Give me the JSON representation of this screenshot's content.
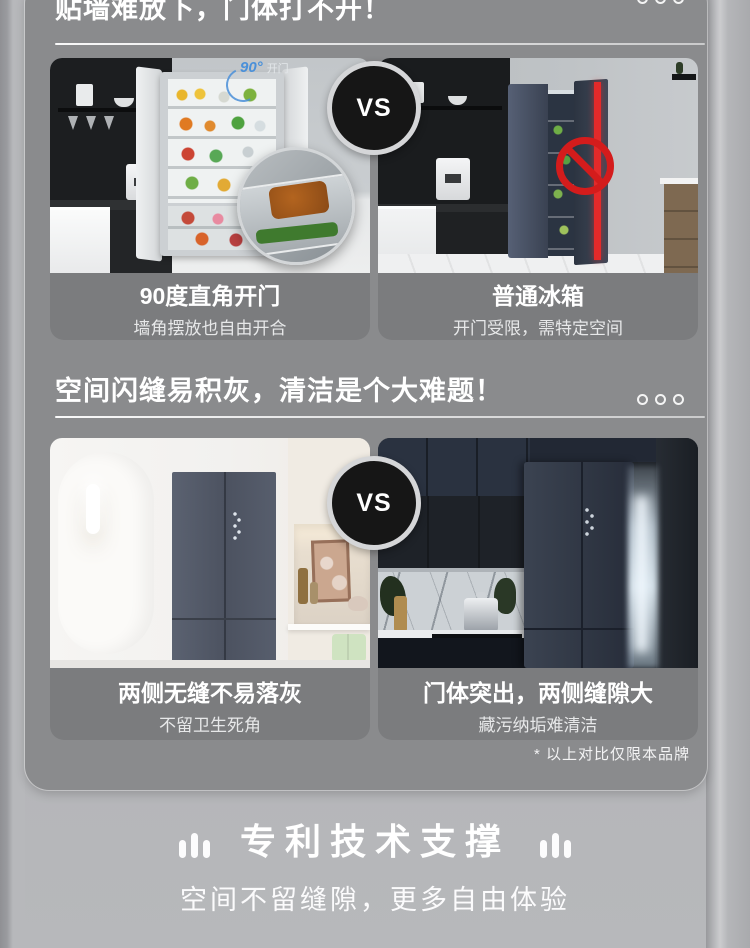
{
  "page": {
    "sections": [
      {
        "title": "贴墙难放下，门体打不开！",
        "vs_label": "VS",
        "left": {
          "overlay_degree": "90°",
          "overlay_text": "开门",
          "caption_title": "90度直角开门",
          "caption_subtitle": "墙角摆放也自由开合"
        },
        "right": {
          "caption_title": "普通冰箱",
          "caption_subtitle": "开门受限，需特定空间"
        }
      },
      {
        "title": "空间闪缝易积灰，清洁是个大难题！",
        "vs_label": "VS",
        "left": {
          "caption_title": "两侧无缝不易落灰",
          "caption_subtitle": "不留卫生死角"
        },
        "right": {
          "caption_title": "门体突出，两侧缝隙大",
          "caption_subtitle": "藏污纳垢难清洁"
        }
      }
    ],
    "footnote": "* 以上对比仅限本品牌",
    "footer": {
      "title": "专利技术支撑",
      "subtitle": "空间不留缝隙，更多自由体验"
    },
    "colors": {
      "panel_gray": "#8a8b8d",
      "caption_gray": "#7b7c7e",
      "background_gray": "#b3b4b7",
      "vs_black": "#161616",
      "accent_blue": "#4a90d9",
      "warning_red": "#d41c1c"
    }
  }
}
